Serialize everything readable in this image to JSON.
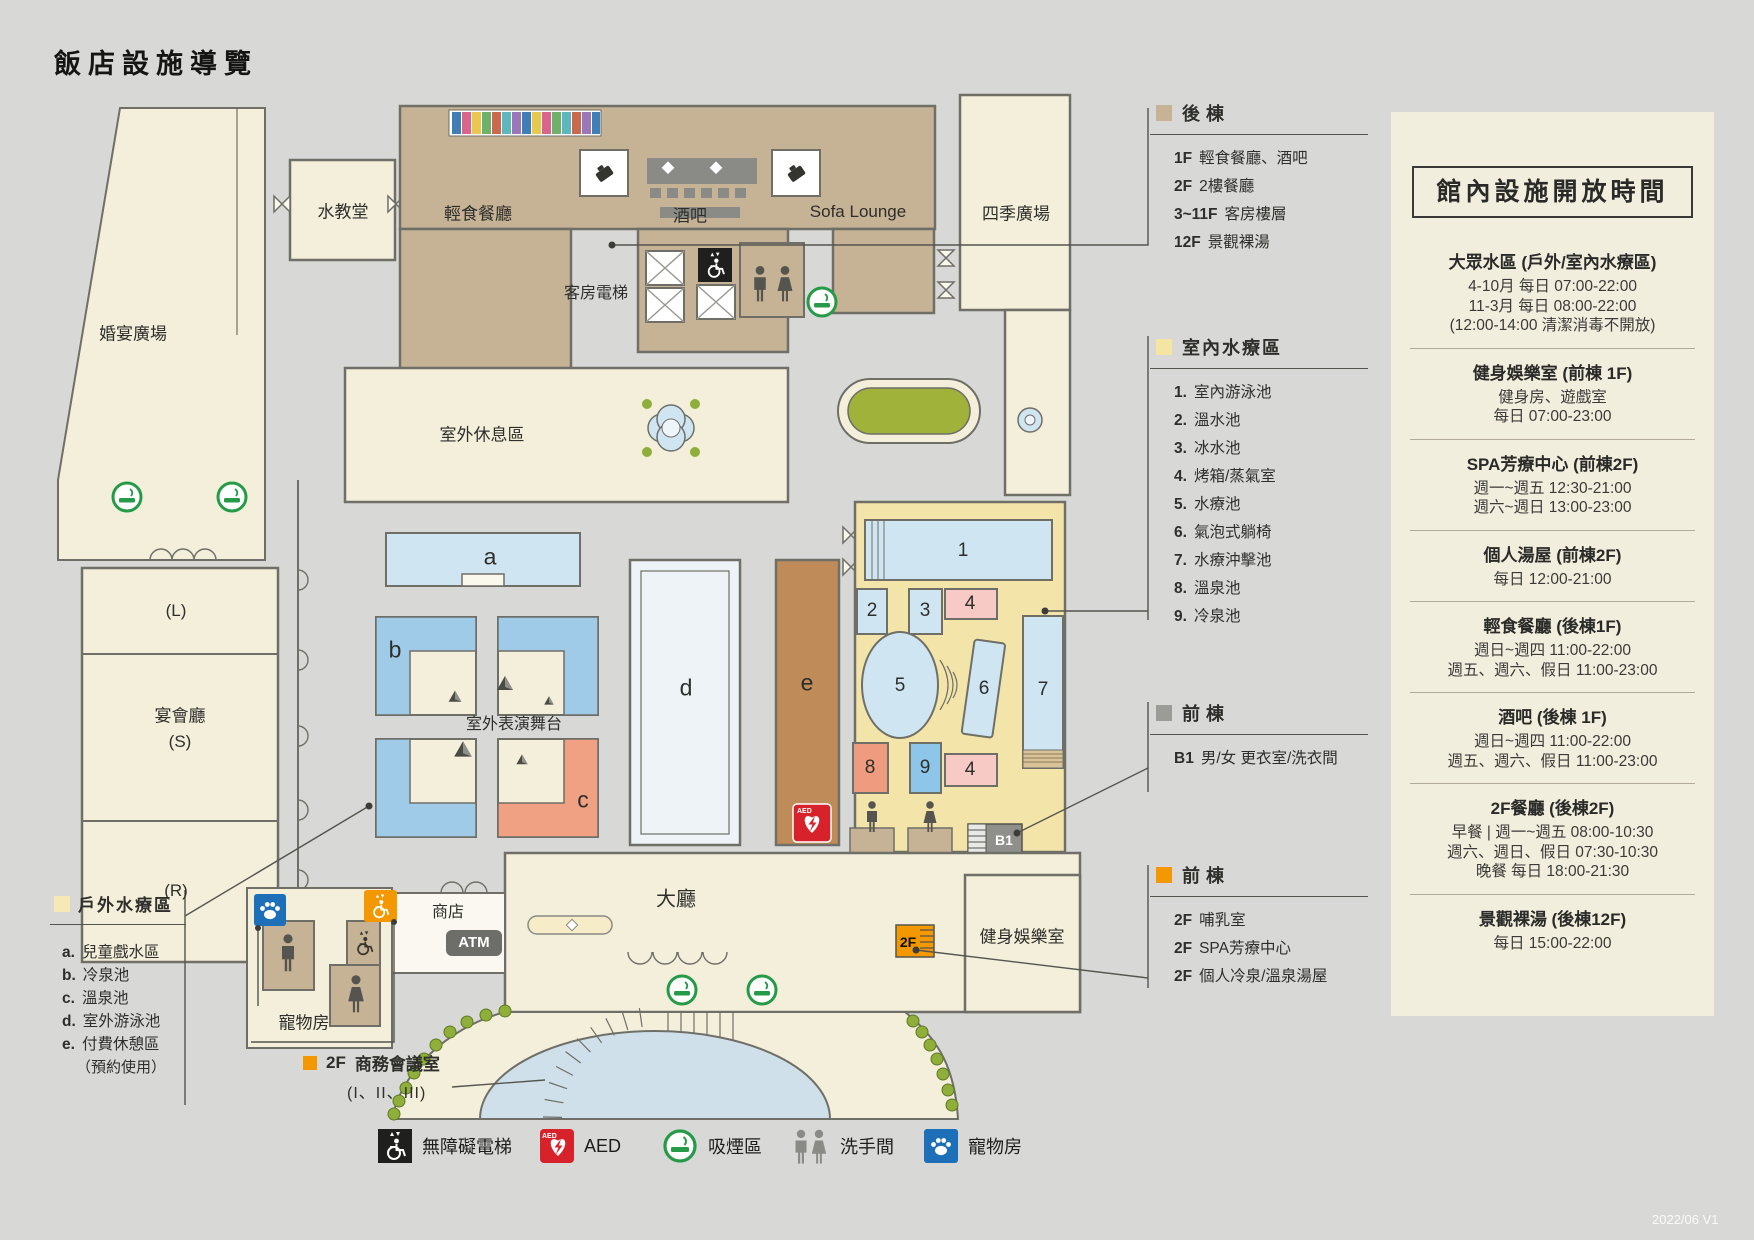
{
  "title": "飯店設施導覽",
  "version": "2022/06 V1",
  "colors": {
    "back_building": "#c6b294",
    "indoor_spa": "#f5e5a3",
    "outdoor_spa": "#f6e9b5",
    "front_building_gray": "#9b9b97",
    "front_building_orange": "#f39800",
    "aed_red": "#d7222c",
    "smoking_green": "#259b48",
    "pet_blue": "#1d6fb8"
  },
  "map": {
    "labels": {
      "water_chapel": "水教堂",
      "light_cafe": "輕食餐廳",
      "bar": "酒吧",
      "sofa_lounge": "Sofa Lounge",
      "four_seasons_plaza": "四季廣場",
      "room_elevator": "客房電梯",
      "wedding_plaza": "婚宴廣場",
      "outdoor_rest": "室外休息區",
      "hall_l": "(L)",
      "banquet_hall": "宴會廳",
      "hall_s": "(S)",
      "hall_r": "(R)",
      "stage": "室外表演舞台",
      "lobby": "大廳",
      "shop": "商店",
      "atm": "ATM",
      "pet_room": "寵物房",
      "fitness": "健身娛樂室",
      "b1": "B1",
      "f2": "2F",
      "pool_a": "a",
      "pool_b": "b",
      "pool_c": "c",
      "pool_d": "d",
      "pool_e": "e",
      "n1": "1",
      "n2": "2",
      "n3": "3",
      "n4a": "4",
      "n5": "5",
      "n6": "6",
      "n7": "7",
      "n8": "8",
      "n9": "9",
      "n4b": "4"
    }
  },
  "legend_back": {
    "title": "後棟",
    "items": [
      {
        "floor": "1F",
        "text": "輕食餐廳、酒吧"
      },
      {
        "floor": "2F",
        "text": "2樓餐廳"
      },
      {
        "floor": "3~11F",
        "text": "客房樓層"
      },
      {
        "floor": "12F",
        "text": "景觀裸湯"
      }
    ]
  },
  "legend_indoor": {
    "title": "室內水療區",
    "items": [
      {
        "n": "1.",
        "t": "室內游泳池"
      },
      {
        "n": "2.",
        "t": "溫水池"
      },
      {
        "n": "3.",
        "t": "冰水池"
      },
      {
        "n": "4.",
        "t": "烤箱/蒸氣室"
      },
      {
        "n": "5.",
        "t": "水療池"
      },
      {
        "n": "6.",
        "t": "氣泡式躺椅"
      },
      {
        "n": "7.",
        "t": "水療沖擊池"
      },
      {
        "n": "8.",
        "t": "溫泉池"
      },
      {
        "n": "9.",
        "t": "冷泉池"
      }
    ]
  },
  "legend_front_b1": {
    "title": "前棟",
    "items": [
      {
        "floor": "B1",
        "text": "男/女 更衣室/洗衣間"
      }
    ]
  },
  "legend_front_2f": {
    "title": "前棟",
    "items": [
      {
        "floor": "2F",
        "text": "哺乳室"
      },
      {
        "floor": "2F",
        "text": "SPA芳療中心"
      },
      {
        "floor": "2F",
        "text": "個人冷泉/溫泉湯屋"
      }
    ]
  },
  "legend_outdoor": {
    "title": "戶外水療區",
    "items": [
      {
        "n": "a.",
        "t": "兒童戲水區"
      },
      {
        "n": "b.",
        "t": "冷泉池"
      },
      {
        "n": "c.",
        "t": "溫泉池"
      },
      {
        "n": "d.",
        "t": "室外游泳池"
      },
      {
        "n": "e.",
        "t": "付費休憩區"
      }
    ],
    "note": "（預約使用）"
  },
  "legend_meeting": {
    "floor": "2F",
    "text": "商務會議室",
    "sub": "(I、II、III)"
  },
  "sidebar": {
    "title": "館內設施開放時間",
    "sections": [
      {
        "heading": "大眾水區 (戶外/室內水療區)",
        "lines": [
          "4-10月 每日 07:00-22:00",
          "11-3月 每日 08:00-22:00",
          "(12:00-14:00 清潔消毒不開放)"
        ]
      },
      {
        "heading": "健身娛樂室 (前棟 1F)",
        "lines": [
          "健身房、遊戲室",
          "每日 07:00-23:00"
        ]
      },
      {
        "heading": "SPA芳療中心 (前棟2F)",
        "lines": [
          "週一~週五 12:30-21:00",
          "週六~週日 13:00-23:00"
        ]
      },
      {
        "heading": "個人湯屋 (前棟2F)",
        "lines": [
          "每日 12:00-21:00"
        ]
      },
      {
        "heading": "輕食餐廳 (後棟1F)",
        "lines": [
          "週日~週四 11:00-22:00",
          "週五、週六、假日 11:00-23:00"
        ]
      },
      {
        "heading": "酒吧 (後棟 1F)",
        "lines": [
          "週日~週四 11:00-22:00",
          "週五、週六、假日 11:00-23:00"
        ]
      },
      {
        "heading": "2F餐廳 (後棟2F)",
        "lines": [
          "早餐 | 週一~週五 08:00-10:30",
          "週六、週日、假日 07:30-10:30",
          "晚餐 每日 18:00-21:30"
        ]
      },
      {
        "heading": "景觀裸湯 (後棟12F)",
        "lines": [
          "每日 15:00-22:00"
        ]
      }
    ]
  },
  "icon_legend": {
    "items": [
      {
        "icon": "accessible-elevator-icon",
        "label": "無障礙電梯"
      },
      {
        "icon": "aed-icon",
        "label": "AED"
      },
      {
        "icon": "smoking-area-icon",
        "label": "吸煙區"
      },
      {
        "icon": "restroom-icon",
        "label": "洗手間"
      },
      {
        "icon": "pet-room-icon",
        "label": "寵物房"
      }
    ]
  }
}
